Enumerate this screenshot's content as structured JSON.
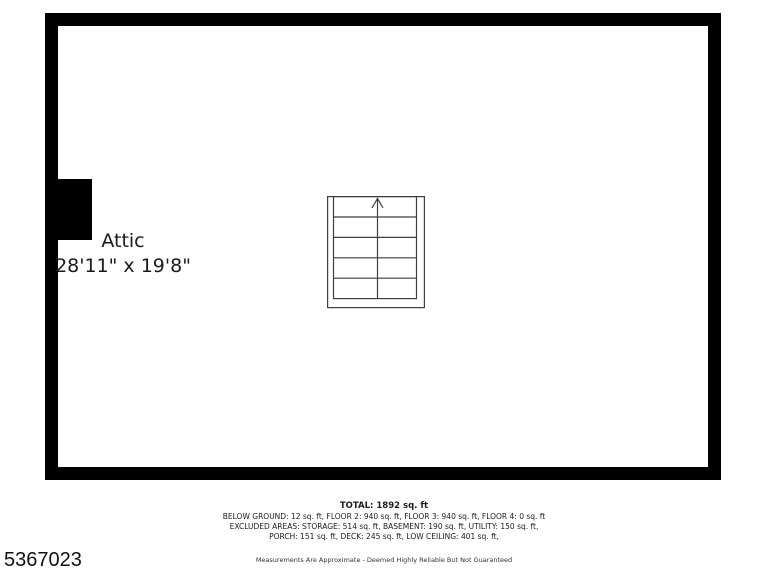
{
  "room": {
    "name": "Attic",
    "dimensions": "28'11\" x 19'8\""
  },
  "summary": {
    "total": "TOTAL: 1892 sq. ft",
    "lines": [
      "BELOW GROUND: 12 sq. ft, FLOOR 2: 940 sq. ft, FLOOR 3: 940 sq. ft, FLOOR 4: 0 sq. ft",
      "EXCLUDED AREAS: STORAGE: 514 sq. ft, BASEMENT: 190 sq. ft, UTILITY: 150 sq. ft,",
      "PORCH: 151 sq. ft, DECK: 245 sq. ft, LOW CEILING: 401 sq. ft,"
    ],
    "disclaimer": "Measurements Are Approximate - Deemed Highly Reliable But Not Guaranteed"
  },
  "mls_number": "5367023",
  "icons": {
    "stairs_arrow": "up-arrow"
  },
  "colors": {
    "wall": "#000000",
    "stair_line": "#3f3f3f",
    "text": "#1a1a1a"
  }
}
